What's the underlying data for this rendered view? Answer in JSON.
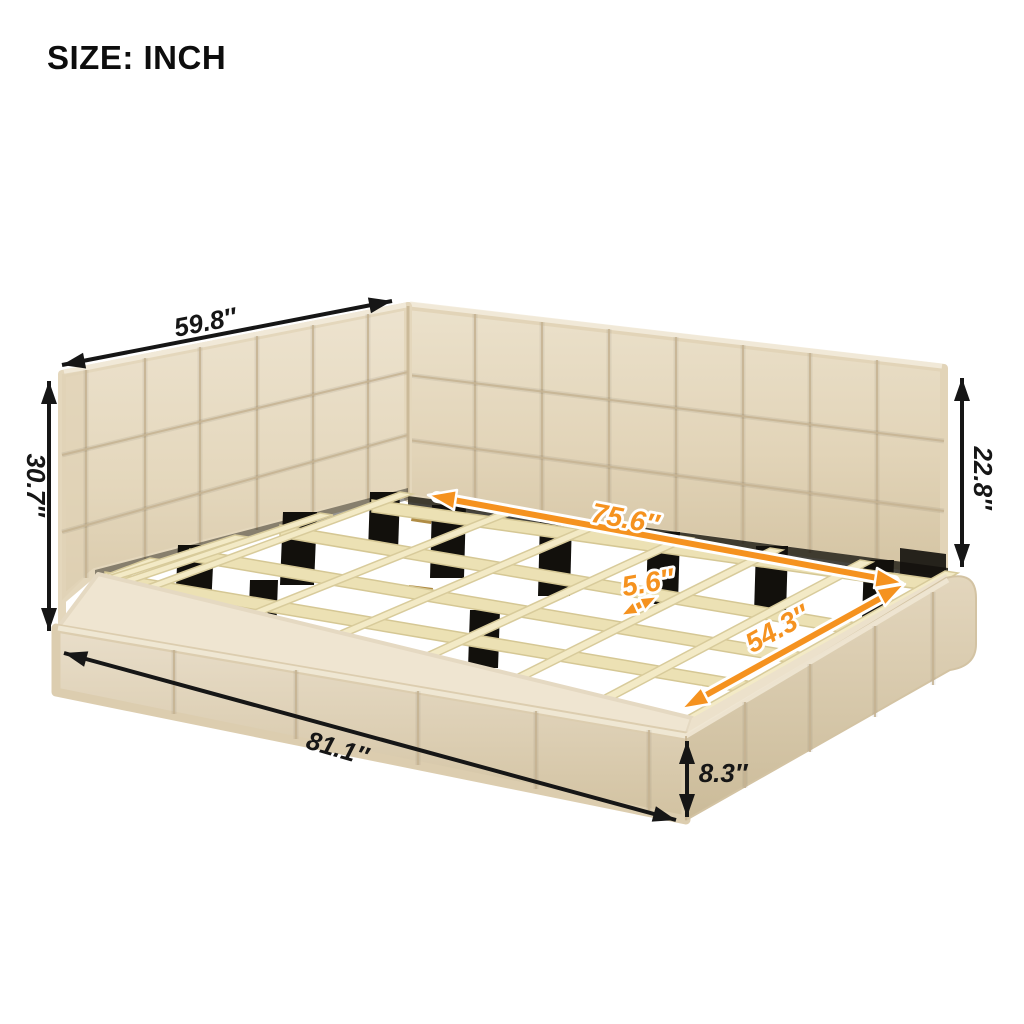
{
  "title": "SIZE: INCH",
  "accent_color": "#f5921f",
  "upholstery_color": "#e7dcc4",
  "dimensions": {
    "headboard_width": "59.8″",
    "headboard_height": "30.7″",
    "backrest_height": "22.8″",
    "slat_area_length": "75.6″",
    "slat_spacing": "5.6″",
    "inner_width": "54.3″",
    "overall_length": "81.1″",
    "base_height": "8.3″"
  }
}
